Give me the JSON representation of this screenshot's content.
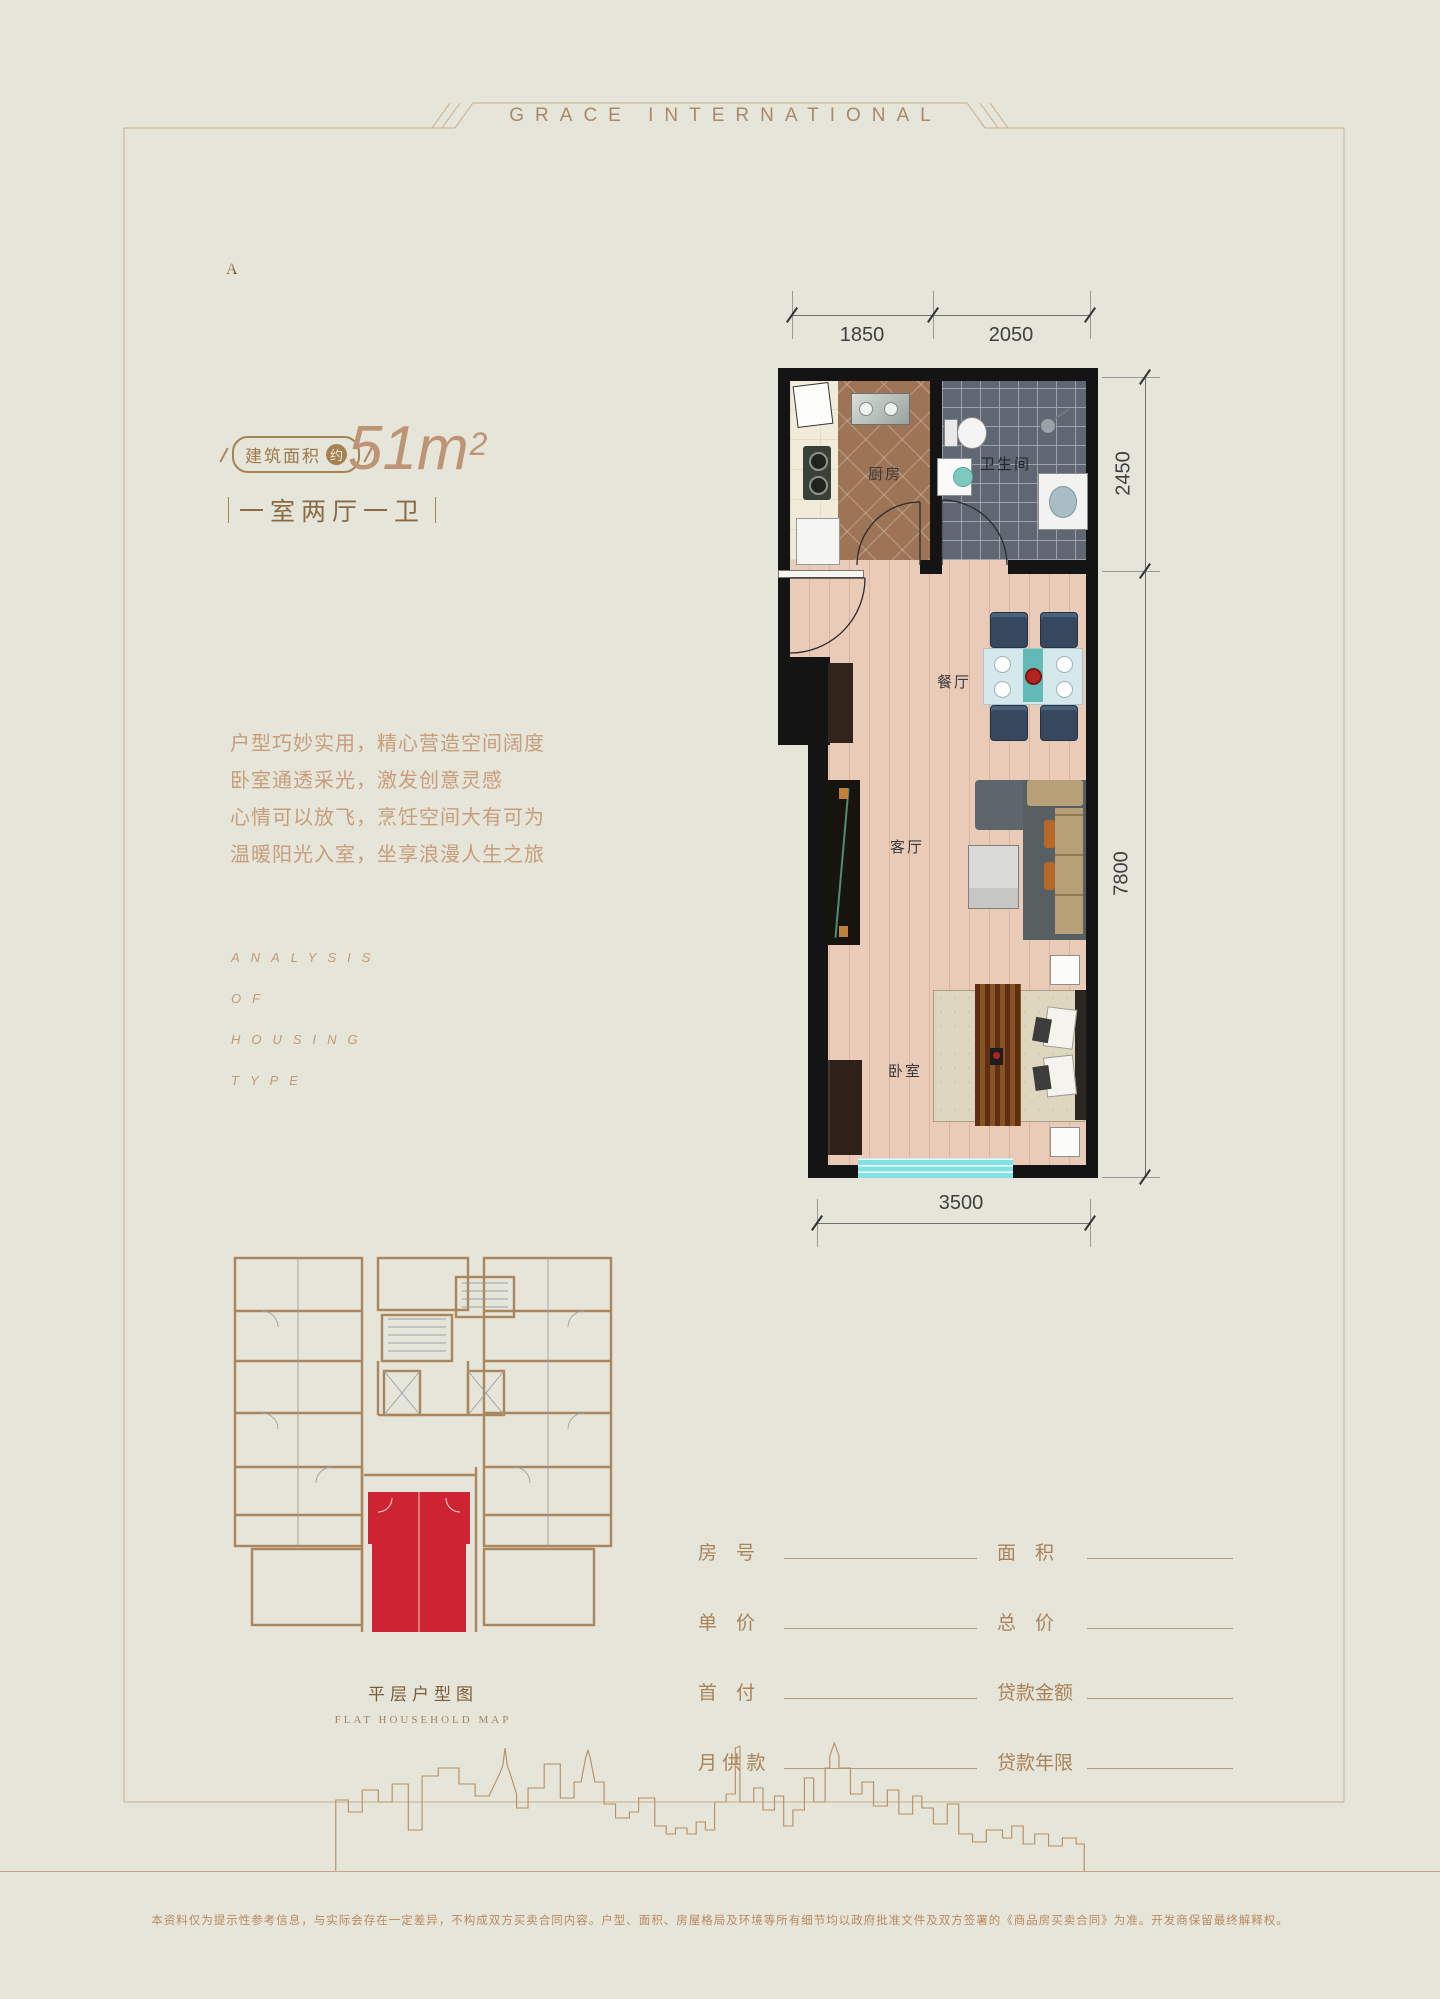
{
  "header": {
    "brand": "GRACE INTERNATIONAL"
  },
  "unit": {
    "letter": "A",
    "area_label": "建筑面积",
    "area_badge": "约",
    "area_value": "51m",
    "area_exponent": "2",
    "layout_type": "一室两厅一卫"
  },
  "description": {
    "lines": [
      "户型巧妙实用，精心营造空间阔度",
      "卧室通透采光，激发创意灵感",
      "心情可以放飞，烹饪空间大有可为",
      "温暖阳光入室，坐享浪漫人生之旅"
    ]
  },
  "analysis": {
    "lines": [
      "ANALYSIS",
      "OF",
      "HOUSING",
      "TYPE"
    ]
  },
  "floorplan": {
    "rooms": {
      "kitchen": "厨房",
      "bathroom": "卫生间",
      "dining": "餐厅",
      "living": "客厅",
      "bedroom": "卧室"
    },
    "dimensions": {
      "top_left": "1850",
      "top_right": "2050",
      "right_top": "2450",
      "right_bottom": "7800",
      "bottom": "3500"
    }
  },
  "keyplan": {
    "title": "平层户型图",
    "subtitle": "FLAT HOUSEHOLD MAP"
  },
  "form": {
    "rows": [
      {
        "left_label": "房　号",
        "right_label": "面　积"
      },
      {
        "left_label": "单　价",
        "right_label": "总　价"
      },
      {
        "left_label": "首　付",
        "right_label": "贷款金额"
      },
      {
        "left_label": "月 供 款",
        "right_label": "贷款年限"
      }
    ]
  },
  "disclaimer": {
    "text": "本资料仅为提示性参考信息，与实际会存在一定差异，不构成双方买卖合同内容。户型、面积、房屋格局及环境等所有细节均以政府批准文件及双方签署的《商品房买卖合同》为准。开发商保留最终解释权。"
  },
  "colors": {
    "accent": "#ab865d",
    "highlight_red": "#ce2333",
    "window_cyan": "#7fe2e7"
  }
}
